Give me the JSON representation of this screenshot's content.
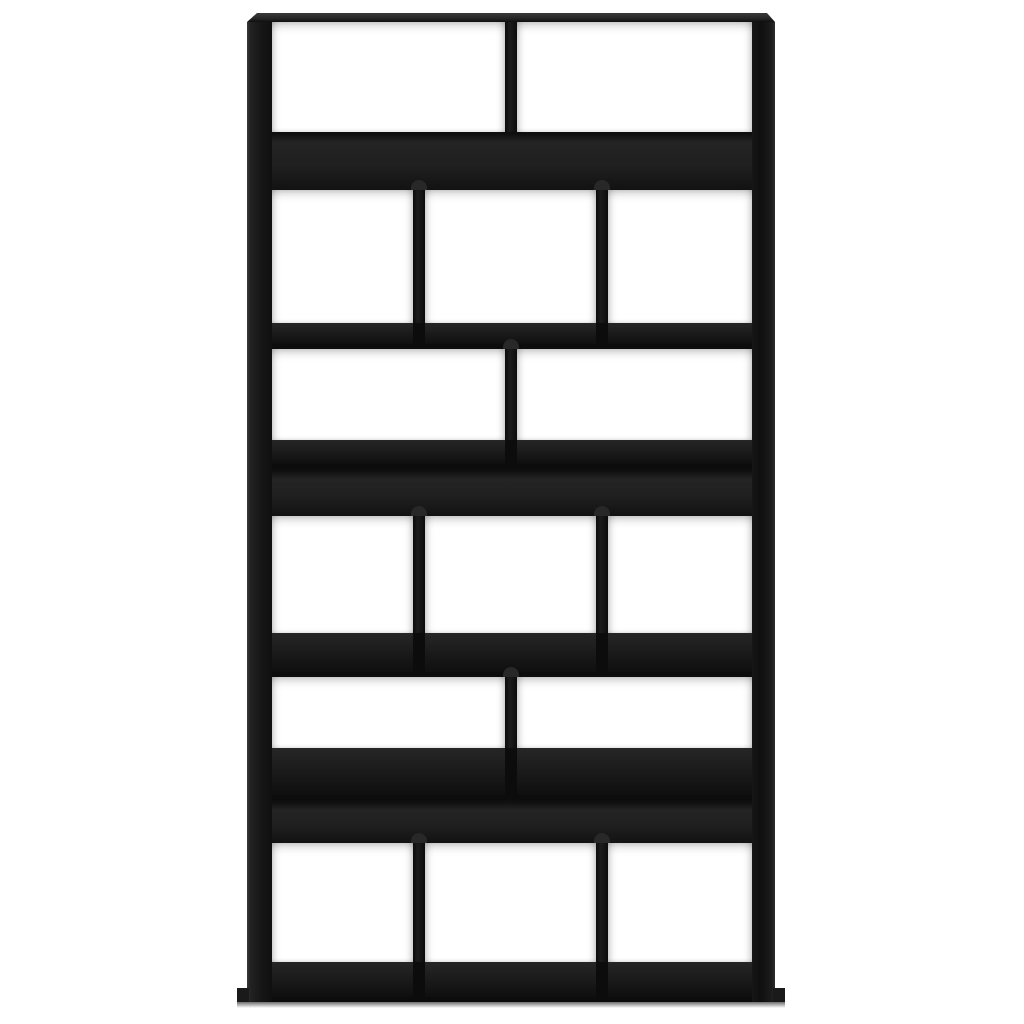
{
  "image": {
    "subject": "black engineered-wood bookcase room divider, front view, 15 open compartments",
    "background_color": "#ffffff"
  },
  "colors": {
    "background": "#ffffff",
    "base": "#141414",
    "band": "#1f1f1f",
    "band_gradient_top": "#0f0f0f",
    "band_mid_light": "#242424",
    "band_bottom": "#121212",
    "opening": "#ffffff",
    "divider": "#1c1c1c",
    "divider_dark": "#0c0c0c",
    "floor_light": "#262626",
    "floor_dark": "#0f0f0f",
    "lip": "#0c0c0c",
    "bump": "#282828",
    "wall_edge": "#3a3a3a",
    "wall_face": "#161616",
    "top_panel_light": "#3a3a3a",
    "top_panel": "#262626",
    "plinth": "#1a1a1a",
    "ground_shadow": "#4a4a4a"
  },
  "bookcase": {
    "frame": {
      "left": 247,
      "top": 13,
      "width": 528,
      "height": 989
    },
    "interior": {
      "left": 272,
      "right": 752
    },
    "top_panel_height": 9,
    "dividers": {
      "two": [
        [
          505,
          517
        ]
      ],
      "three": [
        [
          413,
          425
        ],
        [
          596,
          608
        ]
      ]
    },
    "sections": [
      {
        "type": "row",
        "name": "row-1",
        "cells": 2,
        "top": 22,
        "bottom": 132,
        "bumps": false
      },
      {
        "type": "band",
        "name": "band-1",
        "top": 132,
        "bottom": 190
      },
      {
        "type": "row",
        "name": "row-2",
        "cells": 3,
        "top": 190,
        "bottom": 323,
        "bumps": true
      },
      {
        "type": "gap",
        "name": "shelf-gap-1",
        "cells": 3,
        "top": 323,
        "bottom": 349
      },
      {
        "type": "row",
        "name": "row-3",
        "cells": 2,
        "top": 349,
        "bottom": 440,
        "bumps": true
      },
      {
        "type": "gap",
        "name": "shelf-gap-2",
        "cells": 2,
        "top": 440,
        "bottom": 469
      },
      {
        "type": "band",
        "name": "band-2",
        "top": 469,
        "bottom": 516
      },
      {
        "type": "row",
        "name": "row-4",
        "cells": 3,
        "top": 516,
        "bottom": 633,
        "bumps": true
      },
      {
        "type": "gap",
        "name": "shelf-gap-3",
        "cells": 3,
        "top": 633,
        "bottom": 677
      },
      {
        "type": "row",
        "name": "row-5",
        "cells": 2,
        "top": 677,
        "bottom": 748,
        "bumps": true
      },
      {
        "type": "gap",
        "name": "shelf-gap-4",
        "cells": 2,
        "top": 748,
        "bottom": 800
      },
      {
        "type": "band",
        "name": "band-3",
        "top": 800,
        "bottom": 843
      },
      {
        "type": "row",
        "name": "row-6",
        "cells": 3,
        "top": 843,
        "bottom": 962,
        "bumps": true
      },
      {
        "type": "gap",
        "name": "base-floor",
        "cells": 3,
        "top": 962,
        "bottom": 1002
      }
    ],
    "compartment_count": 15,
    "plinth": {
      "lip_width": 12,
      "lip_height": 14,
      "overhang": 10
    },
    "ground_shadow": {
      "height": 6,
      "overhang": 10
    }
  }
}
